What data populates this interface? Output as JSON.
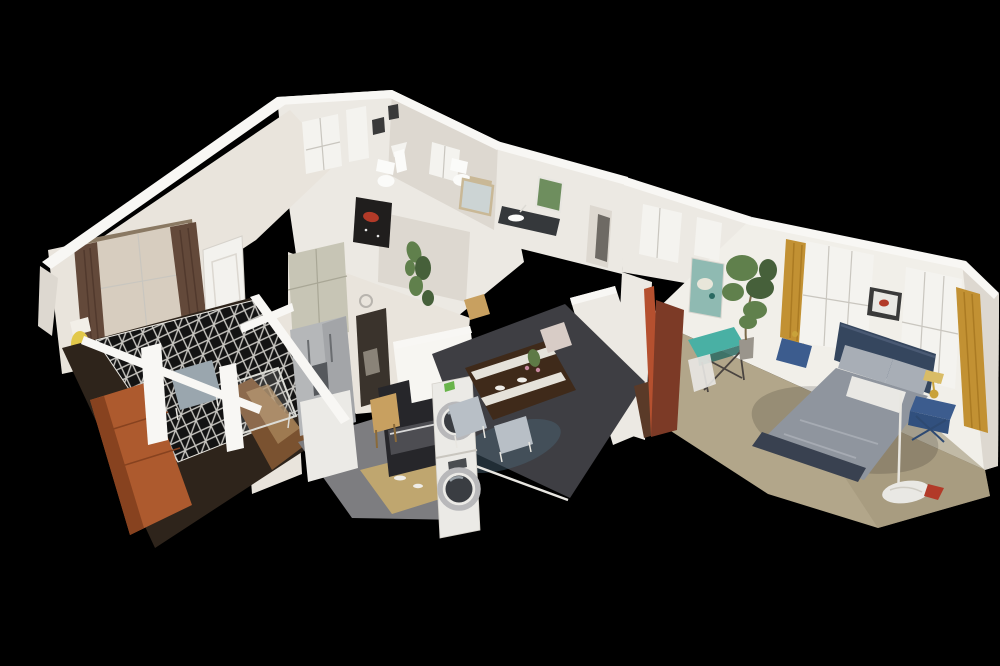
{
  "app": {
    "name": "3d-dollhouse-view",
    "description": "Isometric cutaway dollhouse view of a furnished one-bedroom apartment photogrammetry model floating on a black background"
  },
  "canvas": {
    "width": 1000,
    "height": 666,
    "background": "#000000"
  },
  "rooms": [
    {
      "id": "living-room",
      "label": "Living room"
    },
    {
      "id": "entry",
      "label": "Entry"
    },
    {
      "id": "kitchen",
      "label": "Kitchen"
    },
    {
      "id": "dining-area",
      "label": "Dining area"
    },
    {
      "id": "bathroom",
      "label": "Bathroom"
    },
    {
      "id": "hallway",
      "label": "Hallway"
    },
    {
      "id": "bedroom",
      "label": "Bedroom"
    }
  ],
  "objects": [
    "orange-sofa",
    "patterned-area-rug",
    "glass-coffee-table",
    "gray-armchair",
    "floor-lamp",
    "front-door",
    "window-brown-curtains",
    "refrigerator",
    "upper-cabinets",
    "range-oven",
    "microwave",
    "bar-stool",
    "stacked-washer-dryer",
    "kitchen-island",
    "wall-clock",
    "fire-extinguisher",
    "wall-poster",
    "dining-table",
    "white-table-runner",
    "dining-chairs",
    "toilet",
    "bathroom-mirror",
    "vanity-counter",
    "hanging-vine-plant",
    "abstract-wall-art",
    "queen-bed",
    "navy-headboard",
    "gray-duvet",
    "accent-pillows",
    "blue-nightstand",
    "gold-table-lamp",
    "gold-curtains",
    "sheer-windows",
    "framed-picture",
    "teal-painting",
    "teal-console-table",
    "potted-tree",
    "open-red-door",
    "white-hanging-lamp"
  ],
  "colors": {
    "background": "#000000",
    "wall": "#ece9e3",
    "wallBright": "#f7f6f2",
    "wallShade": "#ddd8d0",
    "wallWarm": "#e9e4dc",
    "bedroomWall": "#f1efe9",
    "beam": "#f8f7f4",
    "livingFloor": "#2e241b",
    "rug": "#131313",
    "rugLine": "#e8e6e0",
    "sofa": "#ad5a2e",
    "sofaDark": "#87421f",
    "chairGray": "#9aa6ae",
    "glass": "#dcdcd6",
    "hallWood": "#7a5230",
    "hallWoodLight": "#a8855a",
    "poster": "#dfcfae",
    "posterArt": "#b98a42",
    "extinguisher": "#c0392b",
    "doorWhite": "#f3f2ee",
    "curtainBrown": "#63493a",
    "lace": "#d7cdbf",
    "lampYellow": "#e2c84a",
    "cabinets": "#c7c5b5",
    "fridge": "#b5b7b9",
    "fridgeDark": "#94979a",
    "stove": "#26262a",
    "stoveLight": "#4d4d52",
    "stool": "#c8a060",
    "washer": "#ebeae6",
    "washerRing": "#b8b8ba",
    "washerGlass": "#3a3d42",
    "kitchenFloor": "#7d7d80",
    "sinkGlow": "#c3a96e",
    "doorway": "#3a332c",
    "diningFloor": "#3e3e43",
    "diningGlow": "#4a6476",
    "table": "#3f2a1a",
    "runner": "#e5e2da",
    "chairLight": "#b8bfc6",
    "chairPink": "#d8ccc6",
    "centerGreen": "#5e7a46",
    "centerPink": "#c98aa0",
    "carpet": "#b2a68a",
    "carpetShade": "#a2967a",
    "bedFrame": "#35465e",
    "duvet": "#8f959e",
    "duvetFold": "#a6abb3",
    "pillow": "#a8aeb6",
    "pillowWhite": "#e9e8e4",
    "bedFoot": "#394150",
    "nightstand": "#3c5c8e",
    "lampGold": "#c9a23a",
    "curtainGold": "#c29133",
    "sheer": "#f4f3ef",
    "plantGreen": "#60804c",
    "plantDark": "#46603a",
    "pot": "#9a958c",
    "teal": "#49b0a4",
    "tealDark": "#2a6a62",
    "paintingTeal": "#8fbab2",
    "doorRed": "#b5502f",
    "doorLeaf": "#7c3a26",
    "artDark": "#201e1d",
    "artRed": "#b23a28",
    "frameDark": "#3a3a3a",
    "mirror": "#ccd4d4",
    "mirrorFrame": "#c9b896",
    "counterDark": "#35383b",
    "windowGreen": "#6e8e5e",
    "toilet": "#fbfbf9",
    "woodDoor": "#5a3a28",
    "pole": "#e8e6e0"
  }
}
